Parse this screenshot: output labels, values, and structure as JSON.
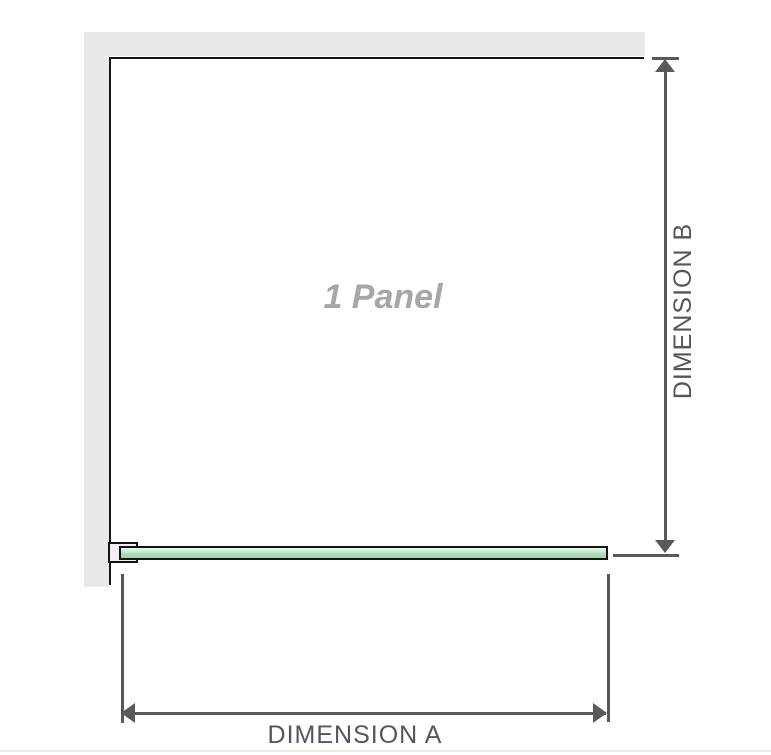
{
  "diagram": {
    "title": "1 Panel",
    "dimension_a": "DIMENSION A",
    "dimension_b": "DIMENSION B"
  },
  "colors": {
    "wall_gray": "#e9e9e9",
    "outline_black": "#141414",
    "dimension_gray": "#58595b",
    "glass_green": "#a8dcb6",
    "glass_highlight": "#eef7ef",
    "panel_label_gray": "#a5a7a9",
    "bottom_divider": "#edeae3"
  }
}
